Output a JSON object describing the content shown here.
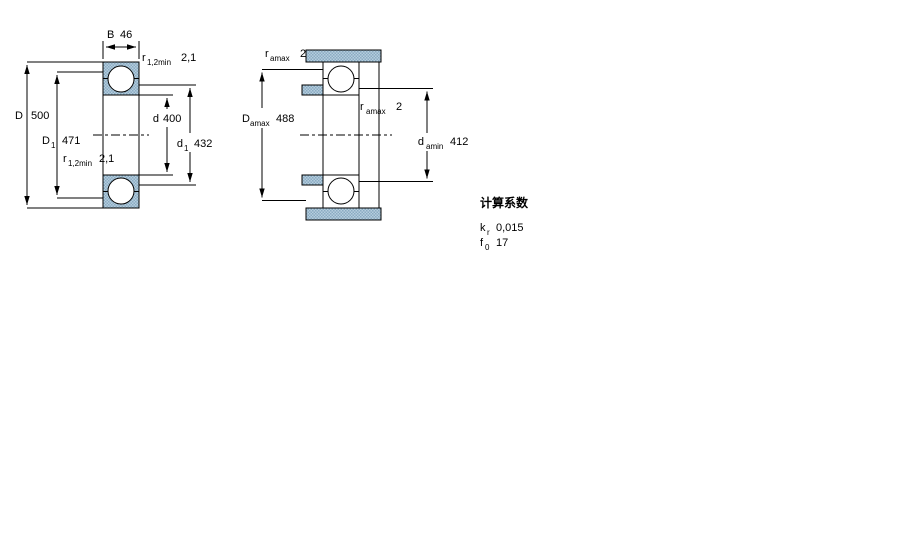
{
  "drawing_title": "bearing-dimension-drawing",
  "colors": {
    "background": "#ffffff",
    "line": "#000000",
    "hatch_base": "#b5cede",
    "hatch_dot": "#8aabc2"
  },
  "left_view": {
    "dim_B": {
      "main": "B",
      "sub": "",
      "value": "46"
    },
    "dim_r_top": {
      "main": "r",
      "sub": "1,2min",
      "value": "2,1"
    },
    "dim_D": {
      "main": "D",
      "sub": "",
      "value": "500"
    },
    "dim_D1": {
      "main": "D",
      "sub": "1",
      "value": "471"
    },
    "dim_d": {
      "main": "d",
      "sub": "",
      "value": "400"
    },
    "dim_d1": {
      "main": "d",
      "sub": "1",
      "value": "432"
    },
    "dim_r_mid": {
      "main": "r",
      "sub": "1,2min",
      "value": "2,1"
    }
  },
  "right_view": {
    "dim_ra_top": {
      "main": "r",
      "sub": "amax",
      "value": "2"
    },
    "dim_Da": {
      "main": "D",
      "sub": "amax",
      "value": "488"
    },
    "dim_ra_mid": {
      "main": "r",
      "sub": "amax",
      "value": "2"
    },
    "dim_da": {
      "main": "d",
      "sub": "amin",
      "value": "412"
    }
  },
  "calculation_factors": {
    "title": "计算系数",
    "rows": [
      {
        "main": "k",
        "sub": "r",
        "value": "0,015"
      },
      {
        "main": "f",
        "sub": "0",
        "value": "17"
      }
    ]
  }
}
